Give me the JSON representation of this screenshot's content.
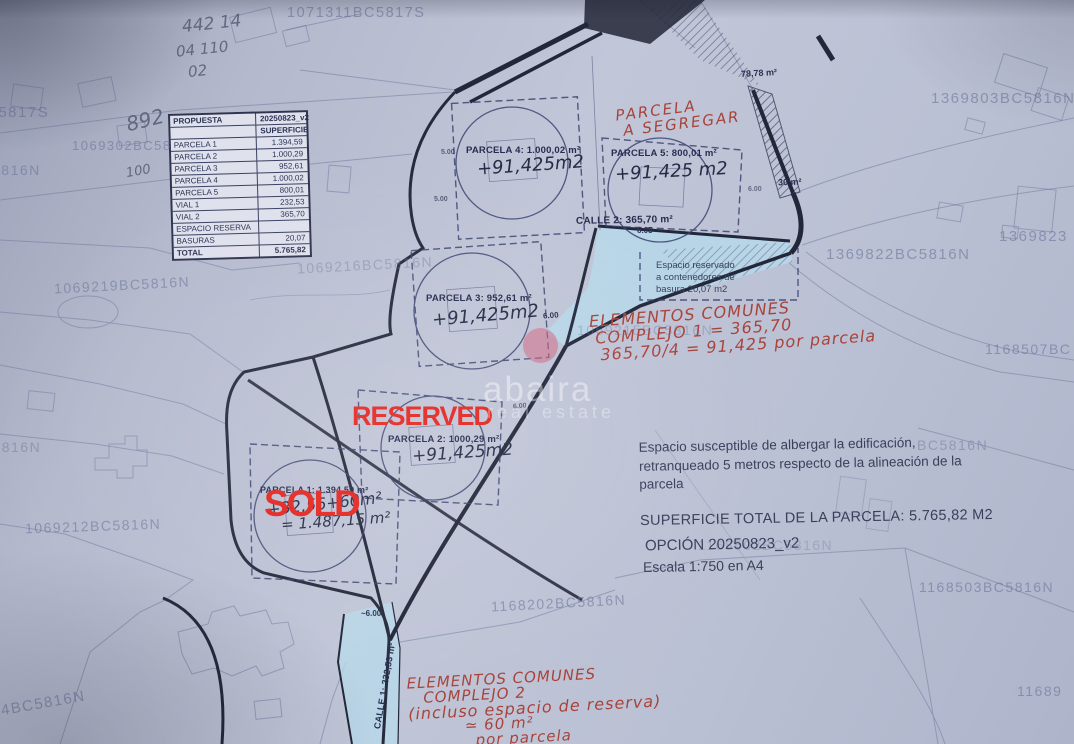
{
  "proposal_table": {
    "title_label": "PROPUESTA",
    "version": "20250823_v2",
    "column_header": "SUPERFICIE",
    "rows": [
      {
        "label": "PARCELA 1",
        "value": "1.394,59"
      },
      {
        "label": "PARCELA 2",
        "value": "1.000,29"
      },
      {
        "label": "PARCELA 3",
        "value": "952,61"
      },
      {
        "label": "PARCELA 4",
        "value": "1.000,02"
      },
      {
        "label": "PARCELA 5",
        "value": "800,01"
      },
      {
        "label": "VIAL 1",
        "value": "232,53"
      },
      {
        "label": "VIAL 2",
        "value": "365,70"
      },
      {
        "label": "ESPACIO RESERVA",
        "value": ""
      },
      {
        "label": "BASURAS",
        "value": "20,07"
      },
      {
        "label": "TOTAL",
        "value": "5.765,82"
      }
    ]
  },
  "parcels": [
    {
      "label": "PARCELA 1: 1.394,59 m²",
      "add_note": "+32,56+60m²",
      "total_note": "= 1.487,15 m²"
    },
    {
      "label": "PARCELA 2: 1000,29 m²",
      "add_note": "+91,425m2"
    },
    {
      "label": "PARCELA 3: 952,61 m²",
      "add_note": "+91,425m2"
    },
    {
      "label": "PARCELA 4: 1.000,02 m²",
      "add_note": "+91,425m2"
    },
    {
      "label": "PARCELA 5: 800,01 m²",
      "add_note": "+91,425 m2"
    }
  ],
  "status_overlays": {
    "reserved": "RESERVED",
    "sold": "SOLD"
  },
  "red_notes": {
    "segregar": [
      "PARCELA",
      "A SEGREGAR"
    ],
    "complejo1": [
      "ELEMENTOS COMUNES",
      "COMPLEJO 1 = 365,70",
      "365,70/4 = 91,425 por parcela"
    ],
    "complejo2": [
      "ELEMENTOS COMUNES",
      "COMPLEJO 2",
      "(incluso espacio de reserva)",
      "≃ 60 m²",
      "por parcela"
    ]
  },
  "printed_notes": {
    "basura": [
      "Espacio reservado",
      "a contenedores de",
      "basura 20,07 m2"
    ],
    "edificacion": [
      "Espacio susceptible de albergar la edificación,",
      "retranqueado 5 metros respecto de la alineación de la",
      "parcela"
    ],
    "superficie_total": "SUPERFICIE TOTAL DE LA PARCELA: 5.765,82 M2",
    "opcion": "OPCIÓN 20250823_v2",
    "escala": "Escala 1:750 en A4"
  },
  "streets": {
    "calle1": "CALLE 1: 232,53 m²",
    "calle2": "CALLE 2: 365,70 m²"
  },
  "dim_labels": [
    "78,78 m²",
    "30 m²",
    "6.05",
    "6.00",
    "~6.00",
    "5.00",
    "5.00",
    "6.00",
    "6.00"
  ],
  "cadastral_refs": [
    "1071311BC5817S",
    "C5817S",
    "1069302BC58",
    "5816N",
    "1069219BC5816N",
    "1069216BC5816N",
    "1069215BC5816N",
    "BC5816N",
    "1069212BC5816N",
    "1069214BC5816N",
    "1168202BC5816N",
    "1168502BC5816N",
    "BC5816N",
    "1369803BC5816N",
    "1369822BC5816N",
    "1369823",
    "1168507BC",
    "1168503BC5816N",
    "11689"
  ],
  "pencil_notes": [
    "442 14",
    "04 110",
    "02",
    "892",
    "100"
  ],
  "watermark": {
    "brand": "abaira",
    "tagline": "real estate"
  },
  "colors": {
    "paper": "#bcc1d4",
    "ink": "#2c3252",
    "faint_ink": "#6d779b",
    "red_hand": "#a8433a",
    "red_overlay": "#e4241f",
    "water": "#b7d9eb"
  }
}
